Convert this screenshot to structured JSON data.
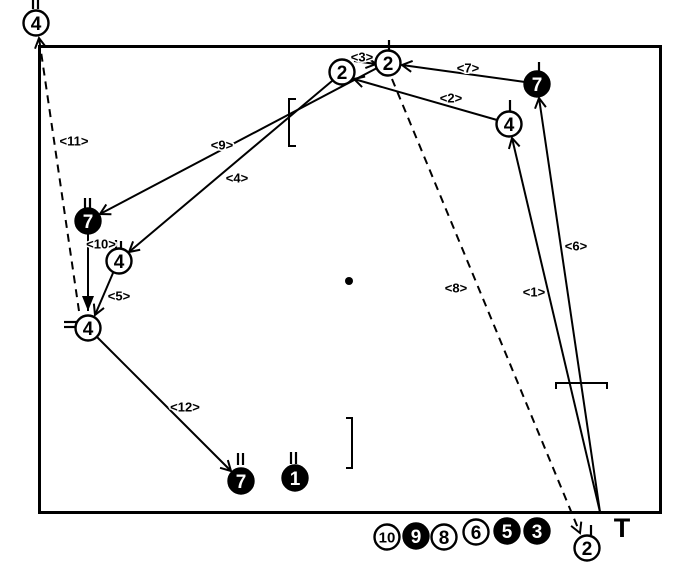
{
  "colors": {
    "ink": "#000000",
    "paper": "#ffffff"
  },
  "diagram": {
    "field": {
      "x": 38,
      "y": 45,
      "width": 624,
      "height": 469,
      "stroke_width": 3
    },
    "jack": {
      "x": 349,
      "y": 281,
      "r": 4
    },
    "tee": {
      "label": "T",
      "x": 622,
      "y": 537
    },
    "balls": [
      {
        "label": "2",
        "x": 342,
        "y": 72,
        "fill": "white",
        "area": "field"
      },
      {
        "label": "2",
        "x": 388,
        "y": 63,
        "fill": "white",
        "area": "field"
      },
      {
        "label": "7",
        "x": 537,
        "y": 84,
        "fill": "black",
        "area": "field"
      },
      {
        "label": "4",
        "x": 509,
        "y": 124,
        "fill": "white",
        "area": "field"
      },
      {
        "label": "7",
        "x": 88,
        "y": 221,
        "fill": "black",
        "area": "field"
      },
      {
        "label": "4",
        "x": 119,
        "y": 261,
        "fill": "white",
        "area": "field"
      },
      {
        "label": "4",
        "x": 88,
        "y": 328,
        "fill": "white",
        "area": "field"
      },
      {
        "label": "7",
        "x": 241,
        "y": 481,
        "fill": "black",
        "area": "field"
      },
      {
        "label": "1",
        "x": 295,
        "y": 478,
        "fill": "black",
        "area": "field"
      },
      {
        "label": "4",
        "x": 36,
        "y": 23,
        "fill": "white",
        "area": "out-top"
      },
      {
        "label": "2",
        "x": 587,
        "y": 548,
        "fill": "white",
        "area": "out-bottom"
      }
    ],
    "bench_balls": [
      {
        "label": "10",
        "x": 387,
        "y": 537,
        "fill": "white"
      },
      {
        "label": "9",
        "x": 416,
        "y": 536,
        "fill": "black"
      },
      {
        "label": "8",
        "x": 444,
        "y": 537,
        "fill": "white"
      },
      {
        "label": "6",
        "x": 476,
        "y": 532,
        "fill": "white"
      },
      {
        "label": "5",
        "x": 507,
        "y": 531,
        "fill": "black"
      },
      {
        "label": "3",
        "x": 537,
        "y": 531,
        "fill": "black"
      }
    ],
    "moves": [
      {
        "id": "1",
        "label": "<1>",
        "from": [
          600,
          512
        ],
        "to": [
          512,
          138
        ],
        "style": "solid",
        "arrow": "normal",
        "label_pos": [
          534,
          292
        ]
      },
      {
        "id": "2",
        "label": "<2>",
        "from": [
          497,
          120
        ],
        "to": [
          354,
          79
        ],
        "style": "solid",
        "arrow": "normal",
        "label_pos": [
          451,
          98
        ]
      },
      {
        "id": "3",
        "label": "<3>",
        "from": [
          354,
          61
        ],
        "to": [
          376,
          64
        ],
        "style": "solid",
        "arrow": "normal",
        "label_pos": [
          362,
          57
        ]
      },
      {
        "id": "4",
        "label": "<4>",
        "from": [
          332,
          81
        ],
        "to": [
          129,
          252
        ],
        "style": "solid",
        "arrow": "normal",
        "label_pos": [
          237,
          178
        ]
      },
      {
        "id": "5",
        "label": "<5>",
        "from": [
          113,
          273
        ],
        "to": [
          95,
          315
        ],
        "style": "solid",
        "arrow": "normal",
        "label_pos": [
          119,
          296
        ]
      },
      {
        "id": "6",
        "label": "<6>",
        "from": [
          600,
          512
        ],
        "to": [
          539,
          98
        ],
        "style": "solid",
        "arrow": "normal",
        "label_pos": [
          576,
          246
        ]
      },
      {
        "id": "7",
        "label": "<7>",
        "from": [
          525,
          82
        ],
        "to": [
          402,
          65
        ],
        "style": "solid",
        "arrow": "normal",
        "label_pos": [
          468,
          68
        ]
      },
      {
        "id": "8",
        "label": "<8>",
        "from": [
          392,
          79
        ],
        "to": [
          580,
          533
        ],
        "style": "dashed",
        "arrow": "normal",
        "label_pos": [
          456,
          288
        ]
      },
      {
        "id": "9",
        "label": "<9>",
        "from": [
          377,
          68
        ],
        "to": [
          100,
          214
        ],
        "style": "solid",
        "arrow": "normal",
        "label_pos": [
          222,
          145
        ]
      },
      {
        "id": "10",
        "label": "<10>",
        "from": [
          88,
          234
        ],
        "to": [
          88,
          311
        ],
        "style": "solid",
        "arrow": "big",
        "label_pos": [
          101,
          244
        ]
      },
      {
        "id": "11",
        "label": "<11>",
        "from": [
          79,
          311
        ],
        "to": [
          39,
          38
        ],
        "style": "dashed",
        "arrow": "normal",
        "label_pos": [
          74,
          141
        ]
      },
      {
        "id": "12",
        "label": "<12>",
        "from": [
          97,
          337
        ],
        "to": [
          231,
          471
        ],
        "style": "solid",
        "arrow": "normal",
        "label_pos": [
          185,
          407
        ]
      }
    ],
    "brackets": [
      {
        "type": "left",
        "points": "296,99 289,99 289,146 296,146"
      },
      {
        "type": "right",
        "points": "346,418 352,418 352,468 346,468"
      },
      {
        "type": "horizontal",
        "points": "556,389 556,383 607,383 607,389"
      }
    ],
    "tick_marks": [
      [
        33,
        0,
        33,
        9
      ],
      [
        38,
        0,
        38,
        9
      ],
      [
        389,
        40,
        389,
        52
      ],
      [
        539,
        62,
        539,
        73
      ],
      [
        510,
        100,
        510,
        111
      ],
      [
        85,
        198,
        85,
        210
      ],
      [
        90,
        198,
        90,
        210
      ],
      [
        116,
        240,
        116,
        250
      ],
      [
        121,
        241,
        121,
        251
      ],
      [
        64,
        322,
        78,
        322
      ],
      [
        64,
        327,
        78,
        327
      ],
      [
        238,
        453,
        238,
        465
      ],
      [
        243,
        453,
        243,
        465
      ],
      [
        291,
        452,
        291,
        464
      ],
      [
        296,
        452,
        296,
        464
      ],
      [
        591,
        525,
        591,
        535
      ]
    ]
  }
}
